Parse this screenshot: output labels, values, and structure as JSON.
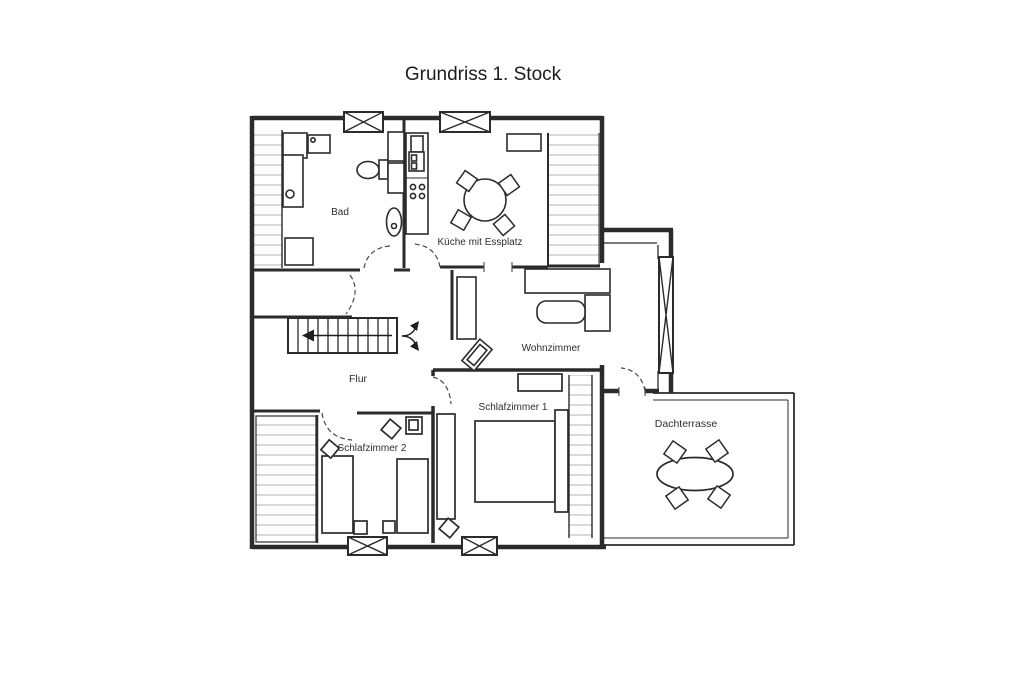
{
  "title": "Grundriss 1. Stock",
  "diagram": {
    "type": "floor-plan",
    "floor": "1. Stock"
  },
  "rooms": {
    "bad": {
      "label": "Bad"
    },
    "kueche": {
      "label": "Küche mit Essplatz"
    },
    "wohnzimmer": {
      "label": "Wohnzimmer"
    },
    "flur": {
      "label": "Flur"
    },
    "schlafzimmer1": {
      "label": "Schlafzimmer 1"
    },
    "schlafzimmer2": {
      "label": "Schlafzimmer 2"
    },
    "dachterrasse": {
      "label": "Dachterrasse"
    }
  },
  "colors": {
    "line": "#2b2b2b",
    "hatch": "#b9b9b9",
    "background": "#ffffff"
  }
}
